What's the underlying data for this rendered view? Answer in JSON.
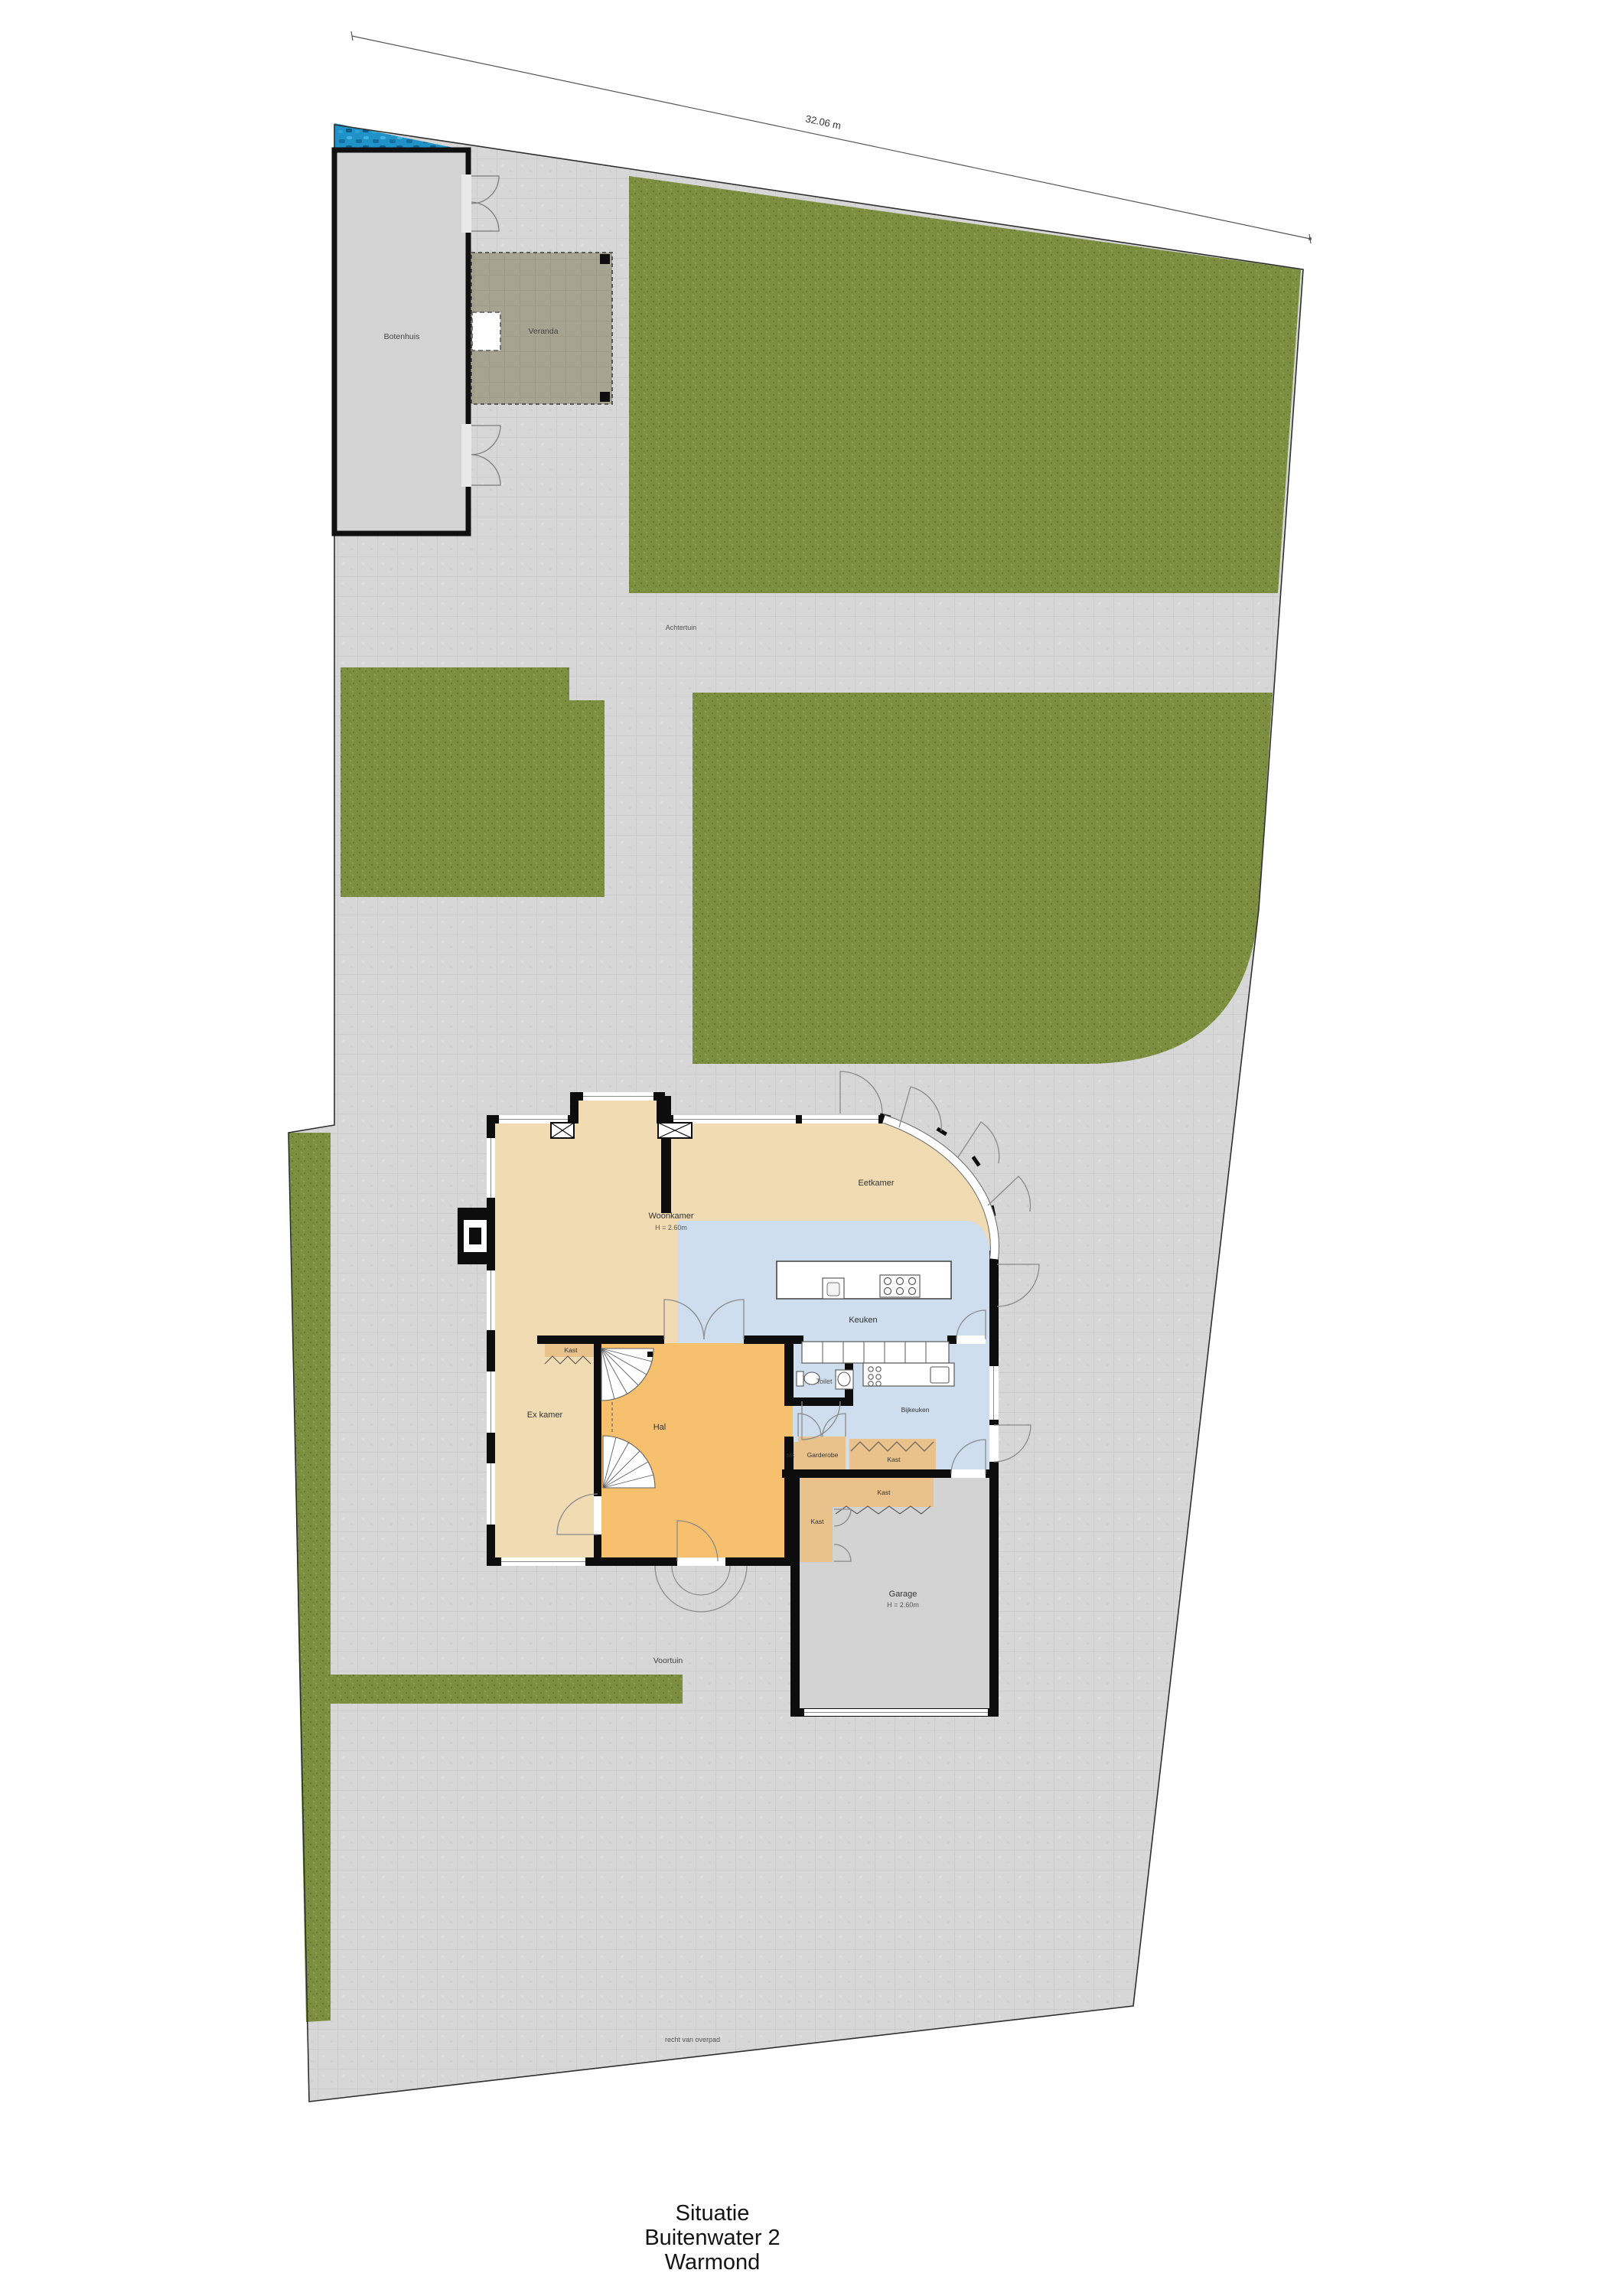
{
  "header": {
    "dimension_label": "32.06 m"
  },
  "site": {
    "botenhuis_label": "Botenhuis",
    "veranda_label": "Veranda",
    "achtertuin_label": "Achtertuin",
    "voortuin_label": "Voortuin",
    "easement_label": "recht van overpad"
  },
  "rooms": {
    "woonkamer": "Woonkamer",
    "woonkamer_height": "H = 2.60m",
    "eetkamer": "Eetkamer",
    "keuken": "Keuken",
    "toilet": "Toilet",
    "bijkeuken": "Bijkeuken",
    "hal": "Hal",
    "ex_kamer": "Ex kamer",
    "kast_hal": "Kast",
    "kast_bijkeuken": "Kast",
    "kast_garage_top": "Kast",
    "kast_garage_left": "Kast",
    "garderobe": "Garderobe",
    "meterkast": "Mk",
    "garage": "Garage",
    "garage_height": "H = 2.60m"
  },
  "title_block": {
    "line1": "Situatie",
    "line2": "Buitenwater 2",
    "line3": "Warmond"
  },
  "colors": {
    "grass": "#7c8f41",
    "paving": "#d7d7d7",
    "water": "#1f93c8",
    "room_beige": "#f0dbb3",
    "room_blue": "#cfdeee",
    "room_orange": "#f6c06e",
    "room_tan": "#e9c28b",
    "veranda": "#a6a491",
    "wall": "#0d0d0d"
  }
}
